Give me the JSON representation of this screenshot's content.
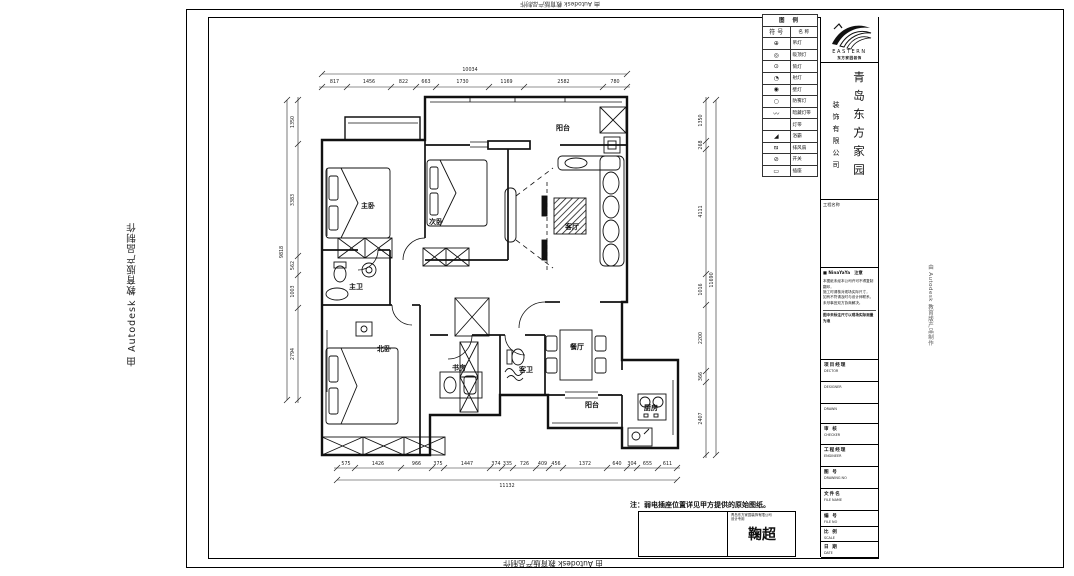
{
  "watermark": {
    "text": "由 Autodesk 教育版产品制作"
  },
  "plan": {
    "rooms": [
      {
        "name": "阳台"
      },
      {
        "name": "主卧"
      },
      {
        "name": "次卧"
      },
      {
        "name": "客厅"
      },
      {
        "name": "主卫"
      },
      {
        "name": "北卧"
      },
      {
        "name": "书房"
      },
      {
        "name": "客卫"
      },
      {
        "name": "餐厅"
      },
      {
        "name": "阳台"
      },
      {
        "name": "厨房"
      }
    ],
    "dims": {
      "top": {
        "total": "10034",
        "segments": [
          "817",
          "1456",
          "822",
          "663",
          "1730",
          "1169",
          "2582",
          "780"
        ]
      },
      "bottom": {
        "total": "11132",
        "segments": [
          "575",
          "1426",
          "966",
          "375",
          "1447",
          "374",
          "335",
          "726",
          "409",
          "456",
          "1372",
          "640",
          "304",
          "655",
          "611"
        ]
      },
      "left": {
        "total": "9818",
        "segments": [
          "1350",
          "3383",
          "562",
          "1003",
          "2794"
        ]
      },
      "right": {
        "total": "11690",
        "segments": [
          "1350",
          "268",
          "4111",
          "1016",
          "2200",
          "366",
          "2407"
        ]
      }
    },
    "note": "注：弱电插座位置详见甲方提供的原始图纸。"
  },
  "legend": {
    "title": "图 例",
    "col_symbol": "符 号",
    "col_name": "名 称",
    "rows": [
      {
        "symbol": "⊕",
        "name": "吊灯"
      },
      {
        "symbol": "◎",
        "name": "吸顶灯"
      },
      {
        "symbol": "⊙",
        "name": "筒灯"
      },
      {
        "symbol": "◔",
        "name": "射灯"
      },
      {
        "symbol": "◉",
        "name": "壁灯"
      },
      {
        "symbol": "○",
        "name": "防雾灯"
      },
      {
        "symbol": "〰",
        "name": "暗藏灯带"
      },
      {
        "symbol": "",
        "name": "灯带"
      },
      {
        "symbol": "◢",
        "name": "浴霸"
      },
      {
        "symbol": "⧅",
        "name": "排风扇"
      },
      {
        "symbol": "⊘",
        "name": "开关"
      },
      {
        "symbol": "▭",
        "name": "插座"
      }
    ]
  },
  "titleblock": {
    "logo_text": "EASTERN",
    "logo_sub": "东方家园装饰",
    "company_main": "青岛东方家园",
    "company_sub": "装饰有限公司",
    "project_label": "工程名称",
    "notice": {
      "header": "■ NinaYaYa　注意",
      "lines": [
        "本图纸未经本公司许可不得复制翻印，",
        "施工时请核对现场实际尺寸，",
        "如有不符请及时与设计师联系，",
        "未尽事宜双方协商解决。"
      ],
      "footer": "图中未标注尺寸以现场实际测量为准"
    },
    "fields": [
      {
        "cn": "项目经理",
        "en": "DECTOR"
      },
      {
        "cn": "",
        "en": "DESIGNER"
      },
      {
        "cn": "",
        "en": "DRAWN"
      },
      {
        "cn": "审 核",
        "en": "CHECKER"
      },
      {
        "cn": "工程经理",
        "en": "ENGINEER"
      },
      {
        "cn": "图 号",
        "en": "DRAWING NO"
      },
      {
        "cn": "文件名",
        "en": "FILE NAME"
      },
      {
        "cn": "编 号",
        "en": "FILE NO"
      },
      {
        "cn": "比 例",
        "en": "SCALE"
      },
      {
        "cn": "日 期",
        "en": "DATE"
      }
    ]
  },
  "namebox": {
    "line1": "青岛东方家园装饰有限公司",
    "line2": "设计专用",
    "signature": "鞠超"
  },
  "colors": {
    "ink": "#111111",
    "paper": "#ffffff"
  }
}
